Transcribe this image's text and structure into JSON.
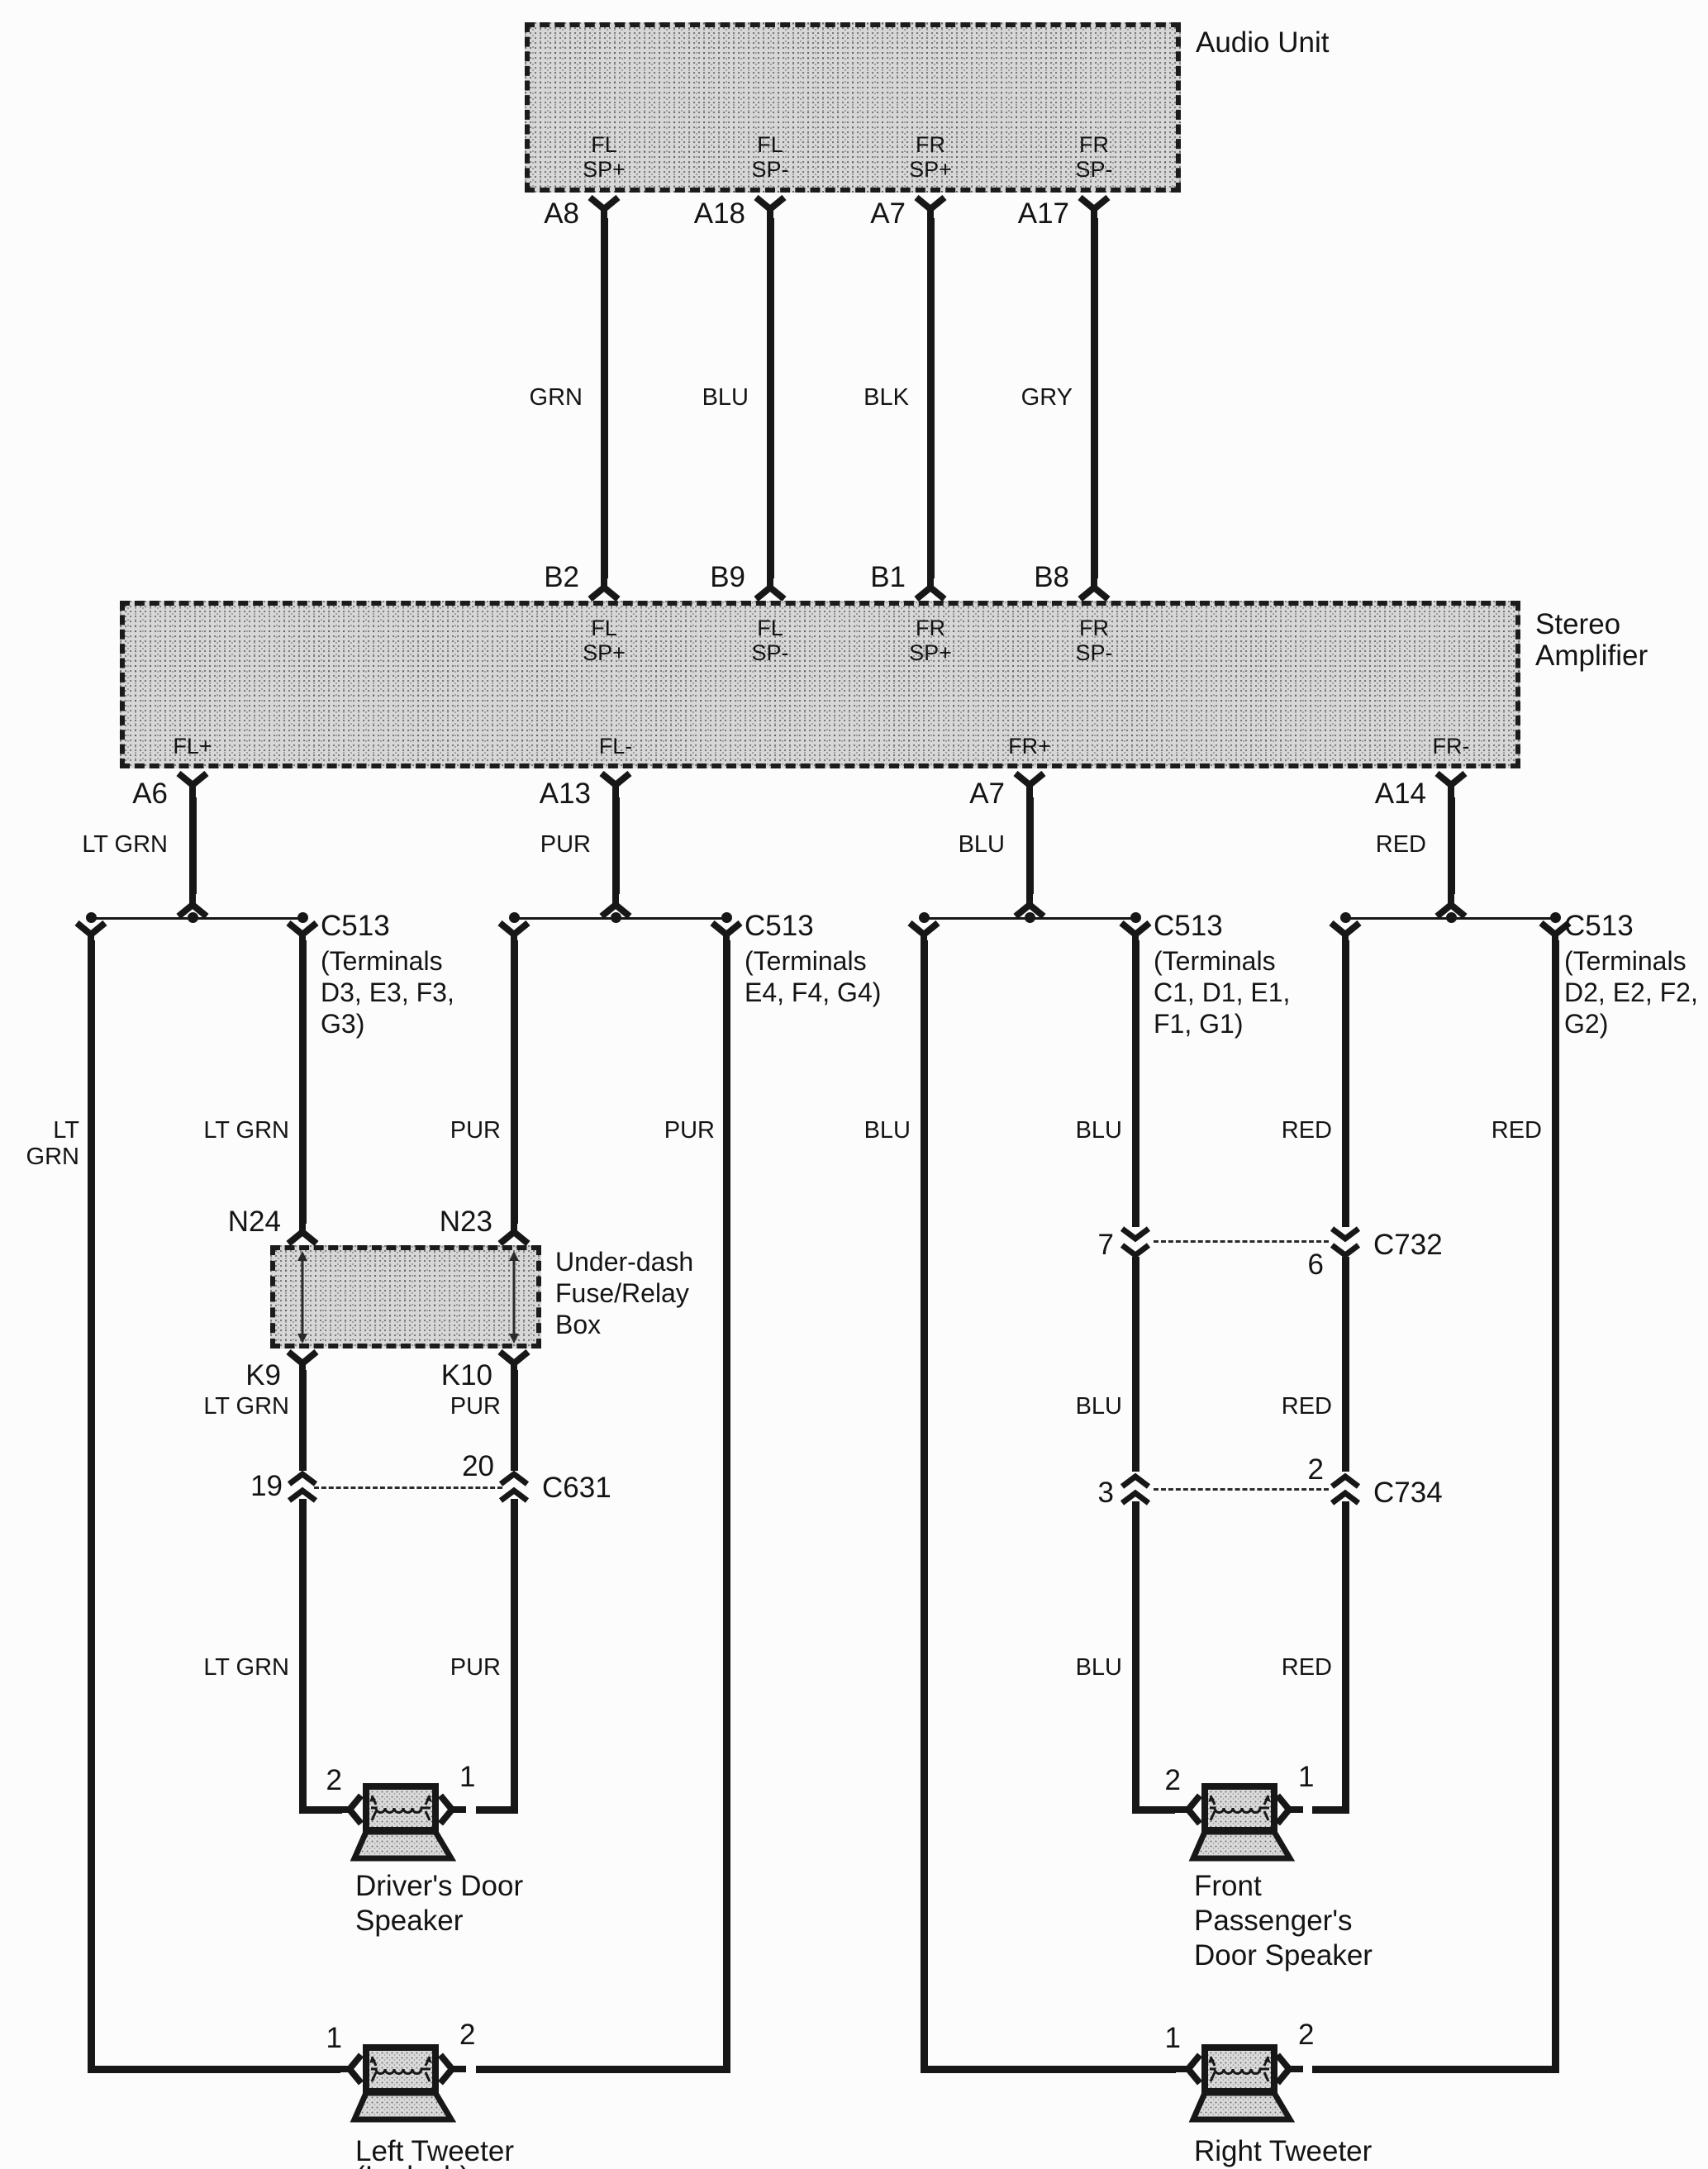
{
  "audio_unit": {
    "title": "Audio Unit",
    "pin_labels": [
      "FL\nSP+",
      "FL\nSP-",
      "FR\nSP+",
      "FR\nSP-"
    ],
    "terminals": [
      "A8",
      "A18",
      "A7",
      "A17"
    ]
  },
  "harness_top": {
    "wire_colors": [
      "GRN",
      "BLU",
      "BLK",
      "GRY"
    ]
  },
  "amplifier": {
    "title": "Stereo\nAmplifier",
    "input_terminals": [
      "B2",
      "B9",
      "B1",
      "B8"
    ],
    "input_pin_labels": [
      "FL\nSP+",
      "FL\nSP-",
      "FR\nSP+",
      "FR\nSP-"
    ],
    "output_pin_labels": [
      "FL+",
      "FL-",
      "FR+",
      "FR-"
    ],
    "output_terminals": [
      "A6",
      "A13",
      "A7",
      "A14"
    ],
    "output_wire_colors": [
      "LT GRN",
      "PUR",
      "BLU",
      "RED"
    ]
  },
  "connectors": {
    "c513": [
      {
        "name": "C513",
        "terminals": "(Terminals\nD3, E3, F3,\nG3)"
      },
      {
        "name": "C513",
        "terminals": "(Terminals\nE4, F4, G4)"
      },
      {
        "name": "C513",
        "terminals": "(Terminals\nC1, D1, E1,\nF1, G1)"
      },
      {
        "name": "C513",
        "terminals": "(Terminals\nD2, E2, F2,\nG2)"
      }
    ],
    "c631": {
      "name": "C631",
      "pin_left": "19",
      "pin_right": "20"
    },
    "c732": {
      "name": "C732",
      "pin_left": "7",
      "pin_right": "6"
    },
    "c734": {
      "name": "C734",
      "pin_left": "3",
      "pin_right": "2"
    }
  },
  "fuse_box": {
    "title": "Under-dash\nFuse/Relay\nBox",
    "top_terminals": [
      "N24",
      "N23"
    ],
    "bottom_terminals": [
      "K9",
      "K10"
    ]
  },
  "wire_colors": {
    "row1": [
      "LT GRN",
      "LT GRN",
      "PUR",
      "PUR",
      "BLU",
      "BLU",
      "RED",
      "RED"
    ],
    "row2": [
      "LT GRN",
      "PUR",
      "BLU",
      "RED"
    ],
    "row3": [
      "LT GRN",
      "PUR",
      "BLU",
      "RED"
    ]
  },
  "speakers": {
    "driver_door": {
      "label": "Driver's Door\nSpeaker",
      "pin_left": "2",
      "pin_right": "1"
    },
    "passenger_door": {
      "label": "Front\nPassenger's\nDoor Speaker",
      "pin_left": "2",
      "pin_right": "1"
    },
    "left_tweeter": {
      "label": "Left Tweeter",
      "sub": "(In dash)",
      "pin_left": "1",
      "pin_right": "2"
    },
    "right_tweeter": {
      "label": "Right Tweeter",
      "pin_left": "1",
      "pin_right": "2"
    }
  }
}
